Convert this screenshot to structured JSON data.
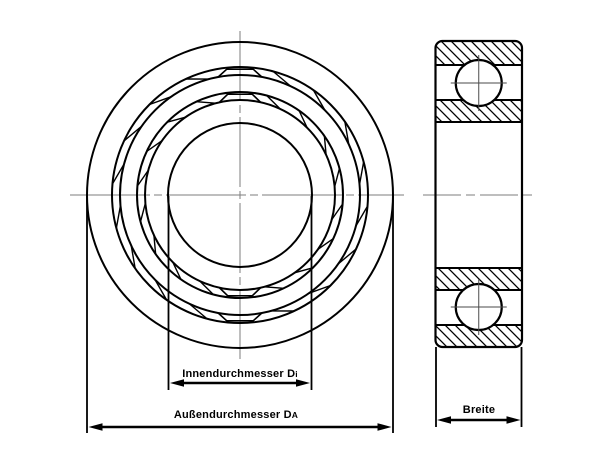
{
  "drawing": {
    "title_name": "ball-bearing-technical-drawing",
    "colors": {
      "line": "#000000",
      "centerline": "#7d7d7d",
      "crosshair": "#4a4a4a",
      "background": "#ffffff"
    },
    "front_view": {
      "dim_inner": {
        "text": "Innendurchmesser D",
        "sub": "i"
      },
      "dim_outer": {
        "text": "Außendurchmesser D",
        "sub": "A"
      }
    },
    "side_view": {
      "dim_width": {
        "text": "Breite",
        "sub": ""
      }
    }
  }
}
